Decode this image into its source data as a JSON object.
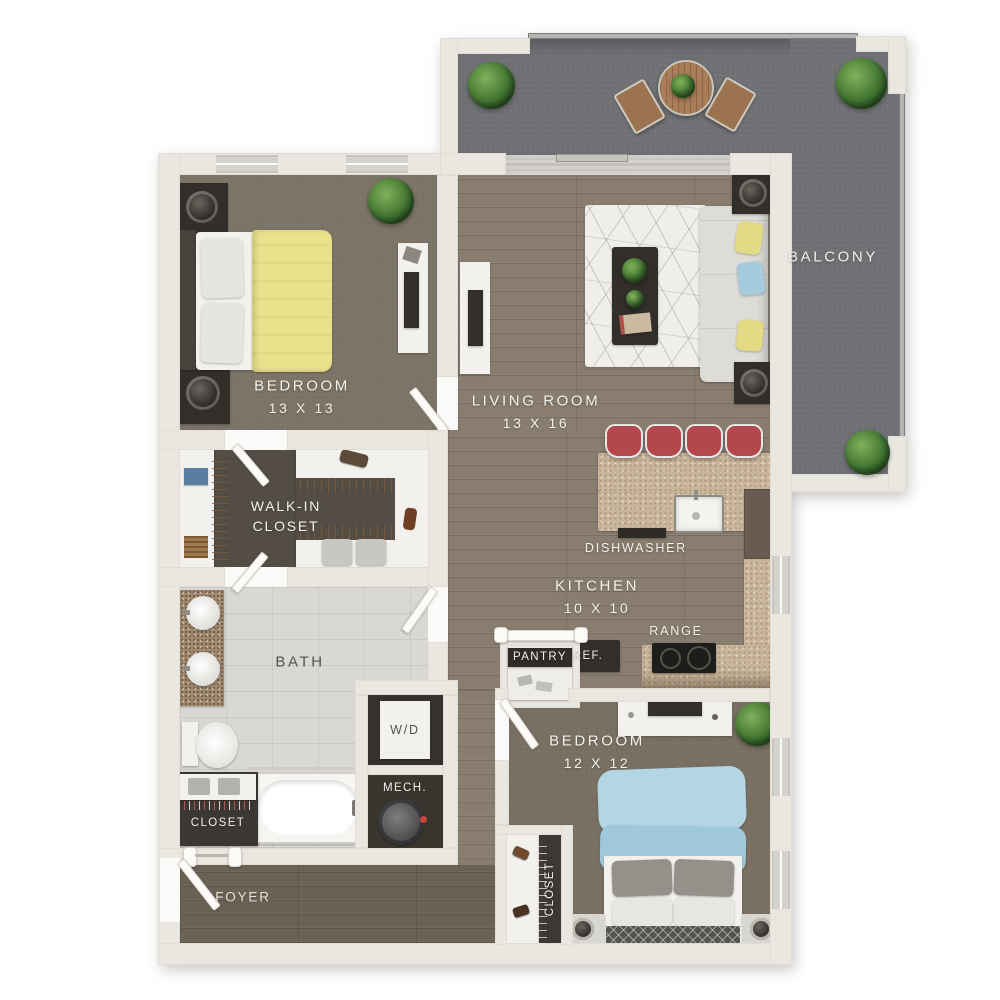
{
  "rooms": {
    "bedroom1": {
      "label": "BEDROOM",
      "dims": "13 X 13"
    },
    "living_room": {
      "label": "LIVING ROOM",
      "dims": "13 X 16"
    },
    "balcony": {
      "label": "BALCONY"
    },
    "walk_in_closet": {
      "label_line1": "WALK-IN",
      "label_line2": "CLOSET"
    },
    "bath": {
      "label": "BATH"
    },
    "kitchen": {
      "label": "KITCHEN",
      "dims": "10 X 10"
    },
    "bedroom2": {
      "label": "BEDROOM",
      "dims": "12 X 12"
    },
    "foyer": {
      "label": "FOYER"
    }
  },
  "fixtures": {
    "dishwasher": "DISHWASHER",
    "range": "RANGE",
    "refrigerator": "REF.",
    "pantry": "PANTRY",
    "washer_dryer": "W/D",
    "mechanical": "MECH.",
    "bath_closet": "CLOSET",
    "bedroom2_closet": "CLOSET"
  },
  "colors": {
    "background": "#ffffff",
    "wall": "#eae7e0",
    "wood_floor": "#897d70",
    "foyer_floor": "#6b6255",
    "carpet_bedroom1": "#7d7568",
    "carpet_bedroom2": "#7a7164",
    "balcony_concrete": "#6f7073",
    "bath_tile": "#dad8d4",
    "closet_floor": "#534d46",
    "counter_speckle": "#c8b59a",
    "stool_red": "#b2484e",
    "bed1_blanket_yellow": "#e9e18c",
    "bed2_blanket_blue": "#a9cfdf",
    "sofa_gray": "#dddcd7",
    "plant_green": "#4c8038"
  }
}
